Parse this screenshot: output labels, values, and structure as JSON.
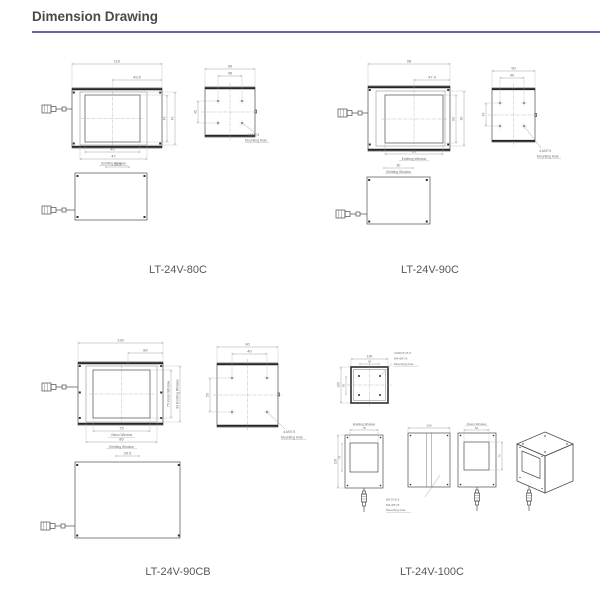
{
  "header": {
    "title": "Dimension Drawing",
    "accent_color": "#7b5fa6"
  },
  "products": {
    "p80c": {
      "label": "LT-24V-80C",
      "front": {
        "dim_width": "110",
        "dim_offset": "49.5",
        "dim_right_inner": "40",
        "dim_right_outer": "45",
        "dim_win_inner": "40",
        "dim_win_outer": "47",
        "win_label": "Emitting Window"
      },
      "back": {
        "dim_width": "90",
        "dim_pitch": "45",
        "dim_pitch_y": "45",
        "note1": "4-M4▽4",
        "note2": "Mounting Hole"
      },
      "side": {
        "dim": "29.5"
      }
    },
    "p90c": {
      "label": "LT-24V-90C",
      "front": {
        "dim_width": "98",
        "dim_offset": "47.4",
        "dim_right_inner": "80",
        "dim_right_outer": "90",
        "dim_win": "80",
        "win_label": "Emitting Window"
      },
      "back": {
        "dim_width": "90",
        "dim_pitch": "40",
        "dim_pitch_y": "40",
        "note1": "4-M4▽4",
        "note2": "Mounting Hole"
      },
      "side": {
        "dim": "80",
        "label": "Emitting Window"
      }
    },
    "p90cb": {
      "label": "LT-24V-90CB",
      "front": {
        "dim_width": "130",
        "dim_offset": "80",
        "right_inner": "75 Vision Window",
        "right_outer": "90 Emitting Window",
        "dim_vision": "75",
        "vision_label": "Vision Window",
        "dim_emit": "80",
        "emit_label": "Emitting Window"
      },
      "back": {
        "dim_width": "90",
        "dim_pitch": "40",
        "dim_pitch_y": "50",
        "note1": "4-M4▽4",
        "note2": "Mounting Hole"
      },
      "side": {
        "dim": "29.5"
      }
    },
    "p100c": {
      "label": "LT-24V-100C",
      "top": {
        "dim_width": "100",
        "dim_pitch": "40",
        "dim_side": "100",
        "dim_pitch_y": "50",
        "note1": "4×Ø3.5▽6.5",
        "note2": "M4-6H▽5",
        "note3": "Mounting hole"
      },
      "front": {
        "dim_win": "75",
        "win_label": "Emitting Window",
        "dim_h": "100",
        "dim_win_h": "75"
      },
      "back": {
        "dim_width": "100",
        "note1": "Ø3.5▽6.5",
        "note2": "M4-6H▽5",
        "note3": "Mounting hole"
      },
      "side": {
        "dim_win": "54",
        "win_label": "Vision Window",
        "dim_right": "75"
      }
    }
  }
}
